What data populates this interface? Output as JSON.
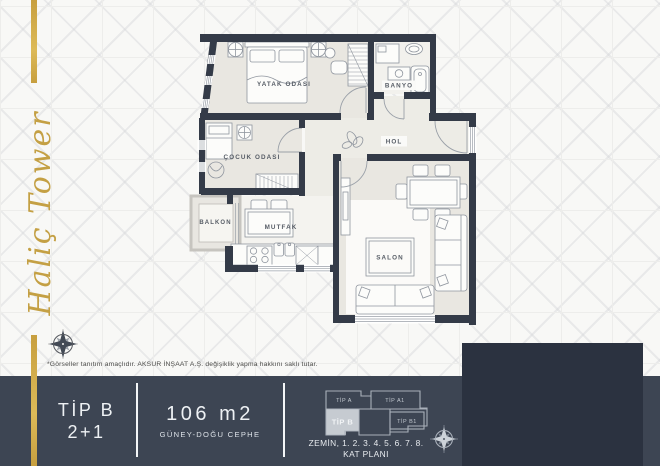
{
  "brand": {
    "title": "Haliç Tower"
  },
  "plan": {
    "rooms": {
      "yatak_odasi": "YATAK ODASI",
      "banyo": "BANYO",
      "cocuk_odasi": "ÇOCUK ODASI",
      "hol": "HOL",
      "balkon": "BALKON",
      "mutfak": "MUTFAK",
      "salon": "SALON"
    }
  },
  "disclaimer": "*Görseller tanıtım amaçlıdır. AKSUR İNŞAAT A.Ş. değişiklik yapma hakkını saklı tutar.",
  "info_bar": {
    "unit_type": "TİP B",
    "unit_layout": "2+1",
    "area": "106 m2",
    "facade": "GÜNEY-DOĞU CEPHE"
  },
  "key_plan": {
    "units": {
      "a": "TİP A",
      "a1": "TİP A1",
      "b": "TİP B",
      "b1": "TİP B1"
    },
    "highlighted_unit": "TİP B",
    "caption_line1": "ZEMİN, 1. 2. 3. 4. 5. 6. 7. 8.",
    "caption_line2": "KAT PLANI"
  },
  "colors": {
    "gold": "#c9a44a",
    "bar": "#3d4553",
    "panel": "#2b3240",
    "wall": "#343b48"
  }
}
